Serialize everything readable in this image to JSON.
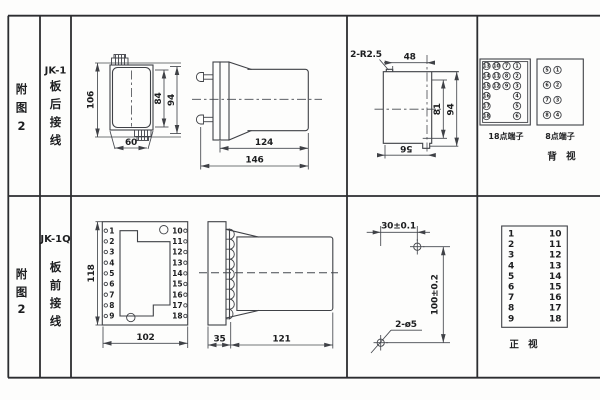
{
  "colors": {
    "line": "#3f4146",
    "text": "#1d1e20",
    "border": "#2c2d30",
    "bg": "#fdfdfc"
  },
  "top_row": {
    "fig_chars": [
      "附",
      "图",
      "2"
    ],
    "model": "JK-1",
    "wiring_chars": [
      "板",
      "后",
      "接",
      "线"
    ],
    "front_view": {
      "overall_height": "106",
      "inner_height": "84",
      "outer_height": "94",
      "width": "60"
    },
    "side_view": {
      "body_length": "124",
      "total_length": "146"
    },
    "cutout": {
      "corner_label": "2-R2.5",
      "top_width": "48",
      "inner_height": "81",
      "outer_height": "94",
      "bottom_width": "56"
    },
    "block18": {
      "label": "18点端子",
      "col1": [
        "13",
        "14",
        "15",
        "16",
        "17",
        "18"
      ],
      "col2": [
        "10",
        "11",
        "12"
      ],
      "col3": [
        "7",
        "8",
        "9"
      ],
      "col4": [
        "1",
        "2",
        "3",
        "4",
        "5",
        "6"
      ]
    },
    "block8": {
      "label": "8点端子",
      "col1": [
        "5",
        "6",
        "7",
        "8"
      ],
      "col2": [
        "1",
        "2",
        "3",
        "4"
      ]
    },
    "view_label": "背  视"
  },
  "bottom_row": {
    "fig_chars": [
      "附",
      "图",
      "2"
    ],
    "model": "JK-1Q",
    "wiring_chars": [
      "板",
      "前",
      "接",
      "线"
    ],
    "front_view": {
      "height": "118",
      "width": "102",
      "left_terminals": [
        "1",
        "2",
        "3",
        "4",
        "5",
        "6",
        "7",
        "8",
        "9"
      ],
      "right_terminals": [
        "10",
        "11",
        "12",
        "13",
        "14",
        "15",
        "16",
        "17",
        "18"
      ]
    },
    "side_view": {
      "plate_depth": "35",
      "body_length": "121"
    },
    "drill": {
      "hole_spacing_h": "30±0.1",
      "hole_spacing_v": "100±0.2",
      "hole_label": "2-ø5"
    },
    "table": {
      "left": [
        "1",
        "2",
        "3",
        "4",
        "5",
        "6",
        "7",
        "8",
        "9"
      ],
      "right": [
        "10",
        "11",
        "12",
        "13",
        "14",
        "15",
        "16",
        "17",
        "18"
      ],
      "view_label": "正  视"
    }
  }
}
